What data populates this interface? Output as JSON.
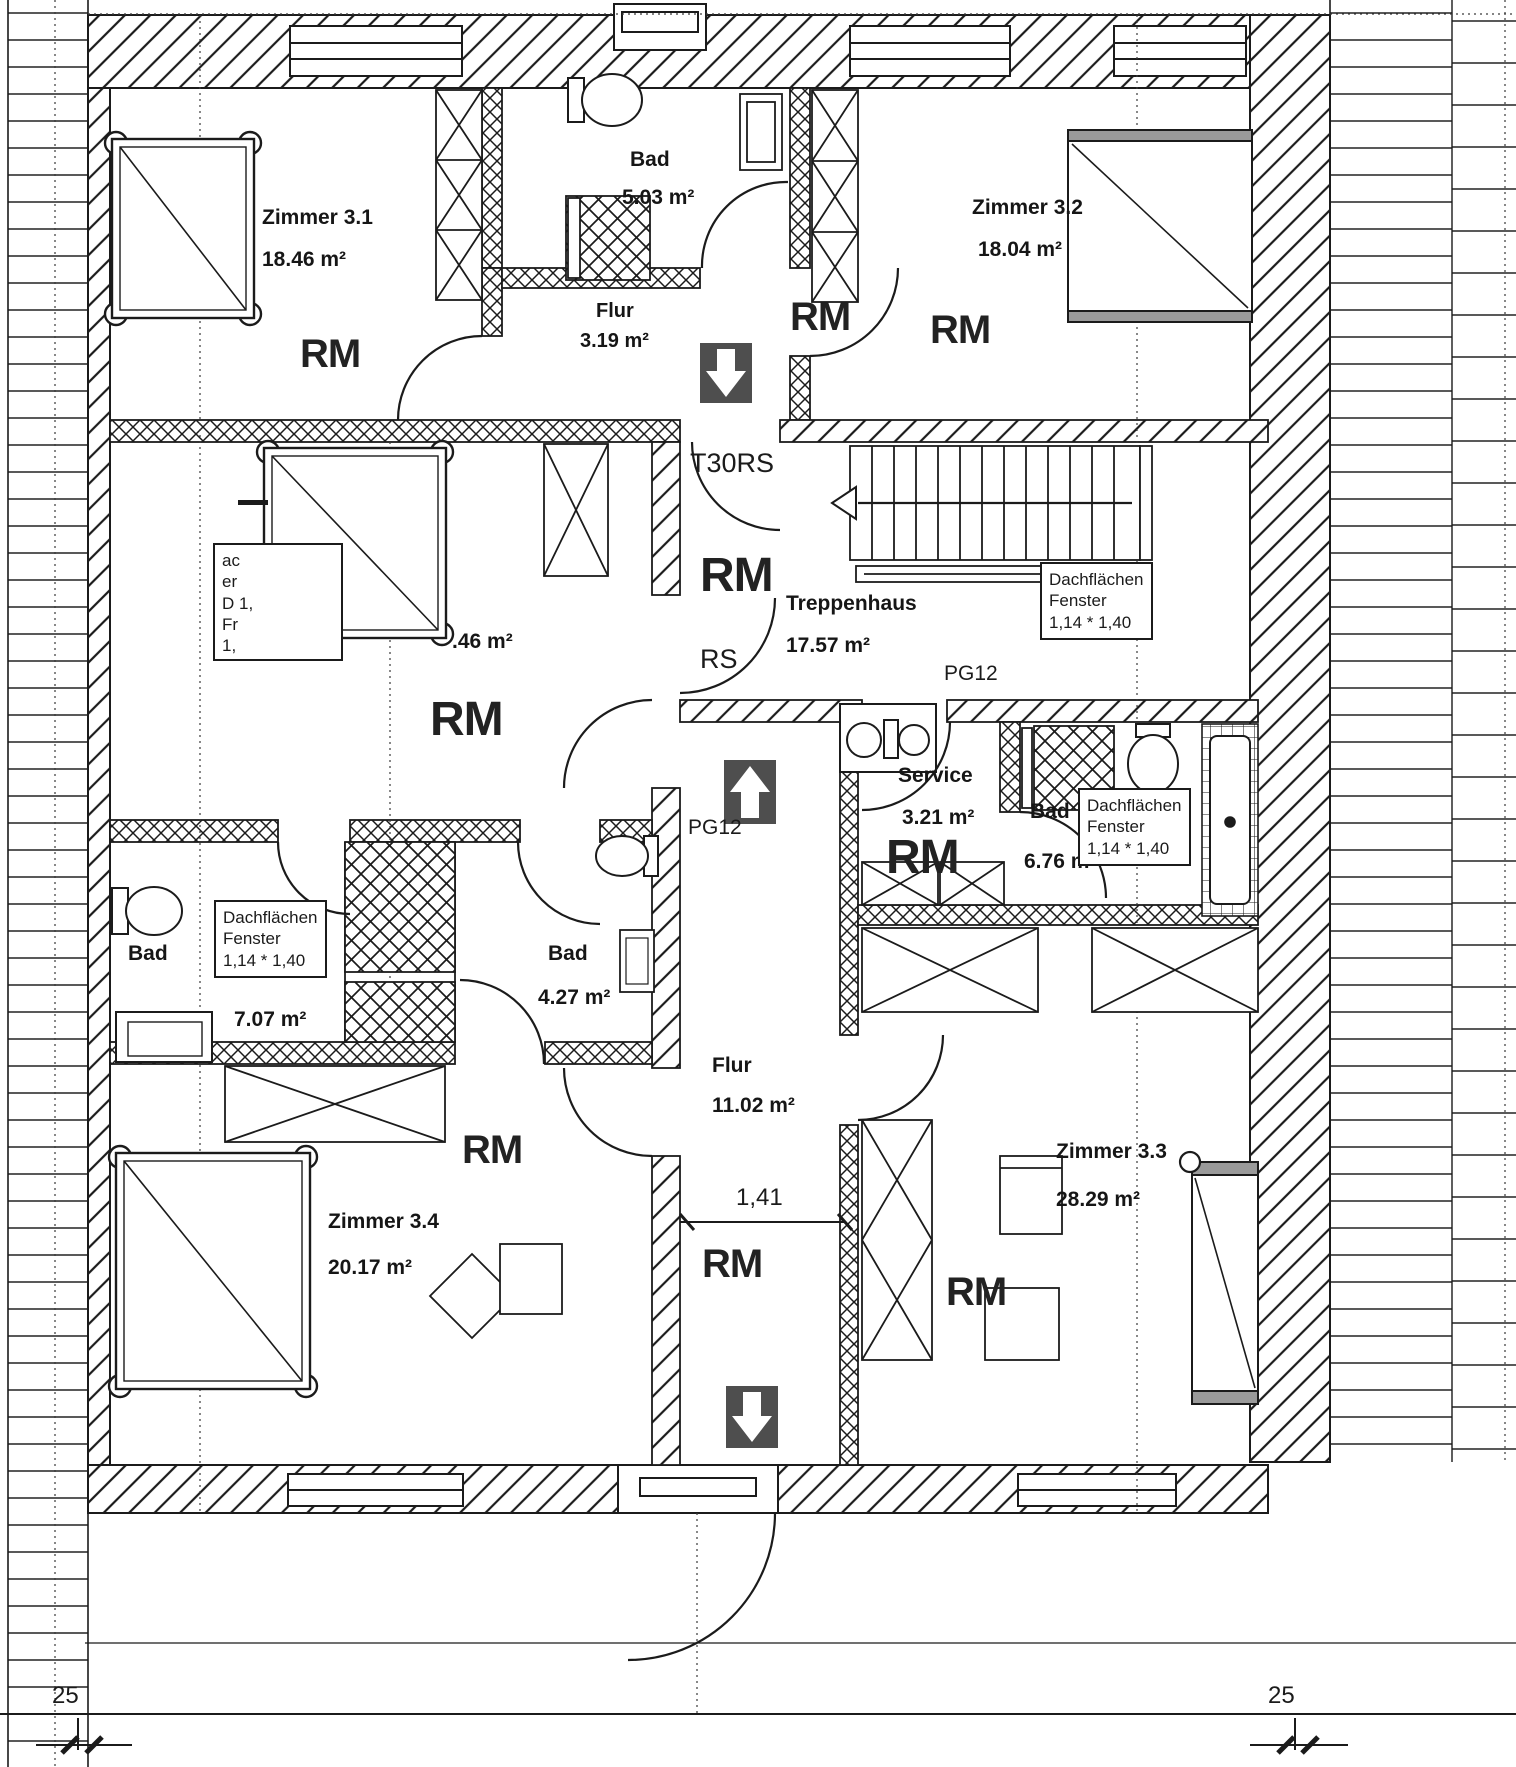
{
  "labels": {
    "rm": "RM",
    "rs": "RS",
    "t30rs": "T30RS",
    "pg12": "PG12",
    "dim_corridor": "1,41",
    "dim_roof": "25"
  },
  "skylight_note": {
    "line1": "Dachflächen",
    "line2": "Fenster",
    "line3": "1,14 * 1,40"
  },
  "partial_note": {
    "lines": [
      "ac",
      "er",
      "D 1,",
      "Fr",
      "1,"
    ]
  },
  "rooms": {
    "zimmer31": {
      "name": "Zimmer 3.1",
      "area": "18.46 m²"
    },
    "bad_top": {
      "name": "Bad",
      "area": "5.03 m²"
    },
    "flur_top": {
      "name": "Flur",
      "area": "3.19 m²"
    },
    "zimmer32": {
      "name": "Zimmer 3.2",
      "area": "18.04 m²"
    },
    "zimmer_mid_left": {
      "area": ".46 m²"
    },
    "treppenhaus": {
      "name": "Treppenhaus",
      "area": "17.57 m²"
    },
    "service": {
      "name": "Service",
      "area": "3.21 m²"
    },
    "bad_mid": {
      "name": "Bad",
      "area": "6.76 m²"
    },
    "bad_left": {
      "name": "Bad",
      "area": "7.07 m²"
    },
    "bad_small": {
      "name": "Bad",
      "area": "4.27 m²"
    },
    "flur_main": {
      "name": "Flur",
      "area": "11.02 m²"
    },
    "zimmer33": {
      "name": "Zimmer 3.3",
      "area": "28.29 m²"
    },
    "zimmer34": {
      "name": "Zimmer 3.4",
      "area": "20.17 m²"
    }
  }
}
